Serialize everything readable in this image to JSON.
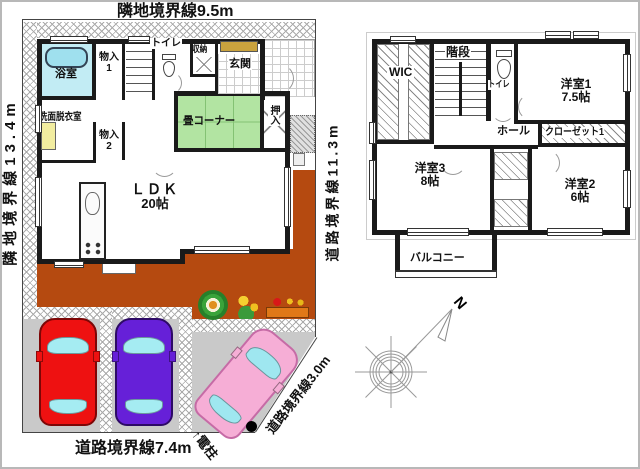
{
  "boundaries": {
    "top": "隣地境界線9.5m",
    "left": "隣地境界線13.4m",
    "road_middle": "道路境界線11.3m",
    "road_bottom": "道路境界線7.4m",
    "road_diagonal": "道路境界線3.0m",
    "pole": "↑電柱",
    "north": "N"
  },
  "floor1": {
    "bath": "浴室",
    "storage1": "物入\n1",
    "toilet": "トイレ",
    "closet": "収納",
    "entrance": "玄関",
    "washroom": "洗面脱衣室",
    "storage2": "物入\n2",
    "tatami_corner": "畳コーナー",
    "oshiire": "押入",
    "ldk_name": "ＬＤＫ",
    "ldk_size": "20帖"
  },
  "floor2": {
    "wic": "WIC",
    "stairs": "階段",
    "toilet": "トイレ",
    "room1_name": "洋室1",
    "room1_size": "7.5帖",
    "closet1": "クローゼット1",
    "hall": "ホール",
    "room3_name": "洋室3",
    "room3_size": "8帖",
    "room2_name": "洋室2",
    "room2_size": "6帖",
    "balcony": "バルコニー"
  },
  "colors": {
    "wall": "#1a1a1a",
    "yard_orange": "#b54a10",
    "parking_gray": "#c9c9c9",
    "tatami_green": "#b2e4a2",
    "bath_blue": "#c2ecf4",
    "tub_blue": "#9fe0ee",
    "sink_yellow": "#f2eda0",
    "cabinet_tan": "#c9a23e",
    "car_red": "#ee1111",
    "car_purple": "#6620d8",
    "car_pink": "#f6aed6",
    "car_window_cyan": "#a5ecf2"
  }
}
